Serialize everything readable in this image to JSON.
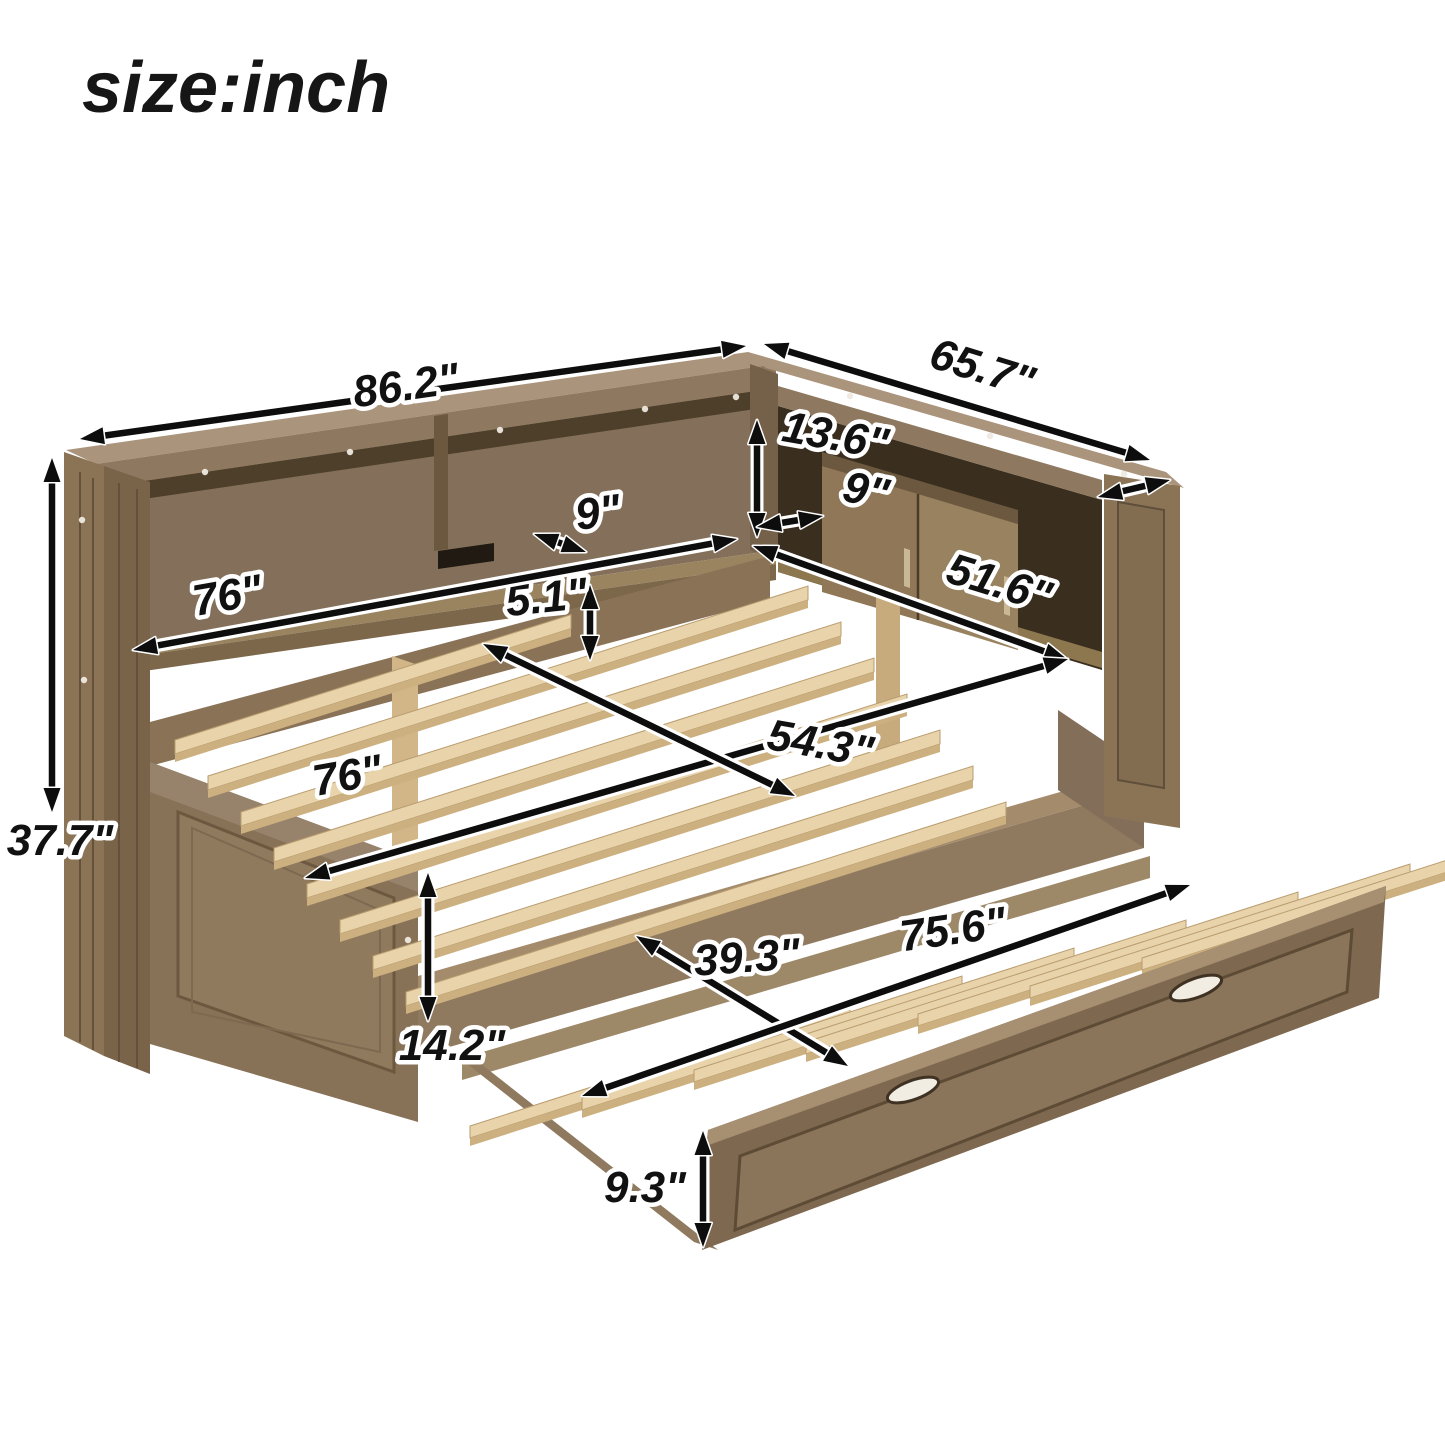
{
  "title": "size:inch",
  "dimensions": {
    "top_total_length": "86.2\"",
    "top_side_depth": "65.7\"",
    "shelf_opening_height": "13.6\"",
    "shelf_depth_left": "9\"",
    "shelf_depth_right": "9\"",
    "gap_under_shelf": "5.1\"",
    "left_shelf_length": "76\"",
    "right_shelf_length": "51.6\"",
    "bed_length": "76\"",
    "bed_width": "54.3\"",
    "total_height": "37.7\"",
    "bed_frame_height": "14.2\"",
    "trundle_width": "39.3\"",
    "trundle_length": "75.6\"",
    "trundle_panel_height": "9.3\""
  },
  "colors": {
    "background": "#ffffff",
    "arrow": "#0d0d0d",
    "label_halo": "#ffffff",
    "label_text": "#111111",
    "wood_cap": "#ab947c",
    "wood_frame": "#8b7456",
    "wood_interior_shadow": "#4e3f2a",
    "slat_wood": "#e8d3aa"
  },
  "annotations": [
    {
      "name": "top-total-length",
      "label": "86.2\"",
      "x": 408,
      "y": 400,
      "rot": -8,
      "arrow": [
        80,
        439,
        746,
        346
      ]
    },
    {
      "name": "top-side-depth",
      "label": "65.7\"",
      "x": 978,
      "y": 382,
      "rot": 17,
      "arrow": [
        764,
        344,
        1150,
        460
      ]
    },
    {
      "name": "top-cap-depth",
      "label": "",
      "x": 0,
      "y": 0,
      "rot": 0,
      "arrow": [
        1098,
        497,
        1170,
        480
      ]
    },
    {
      "name": "shelf-opening-height",
      "label": "13.6\"",
      "x": 833,
      "y": 450,
      "rot": 10,
      "arrow": [
        757,
        420,
        757,
        537
      ]
    },
    {
      "name": "shelf-depth-left",
      "label": "9\"",
      "x": 600,
      "y": 527,
      "rot": -8,
      "arrow": [
        534,
        534,
        586,
        552
      ]
    },
    {
      "name": "shelf-depth-right",
      "label": "9\"",
      "x": 863,
      "y": 505,
      "rot": 12,
      "arrow": [
        757,
        527,
        823,
        516
      ]
    },
    {
      "name": "gap-under-shelf",
      "label": "5.1\"",
      "x": 548,
      "y": 612,
      "rot": -6,
      "arrow": [
        590,
        585,
        590,
        660
      ]
    },
    {
      "name": "left-shelf-length",
      "label": "76\"",
      "x": 230,
      "y": 610,
      "rot": -10,
      "arrow": [
        133,
        650,
        737,
        539
      ]
    },
    {
      "name": "right-shelf-length",
      "label": "51.6\"",
      "x": 995,
      "y": 597,
      "rot": 17,
      "arrow": [
        753,
        546,
        1068,
        660
      ]
    },
    {
      "name": "bed-length",
      "label": "76\"",
      "x": 350,
      "y": 790,
      "rot": -10,
      "arrow": [
        305,
        878,
        1068,
        659
      ]
    },
    {
      "name": "bed-width",
      "label": "54.3\"",
      "x": 818,
      "y": 758,
      "rot": 10,
      "arrow": [
        483,
        644,
        795,
        796
      ]
    },
    {
      "name": "total-height",
      "label": "37.7\"",
      "x": 60,
      "y": 855,
      "rot": 0,
      "arrow": [
        52,
        458,
        52,
        812
      ]
    },
    {
      "name": "bed-frame-height",
      "label": "14.2\"",
      "x": 452,
      "y": 1060,
      "rot": 0,
      "arrow": [
        428,
        873,
        428,
        1021
      ]
    },
    {
      "name": "trundle-width",
      "label": "39.3\"",
      "x": 748,
      "y": 972,
      "rot": -4,
      "arrow": [
        636,
        936,
        848,
        1066
      ]
    },
    {
      "name": "trundle-length",
      "label": "75.6\"",
      "x": 955,
      "y": 944,
      "rot": -8,
      "arrow": [
        582,
        1096,
        1190,
        885
      ]
    },
    {
      "name": "trundle-panel-height",
      "label": "9.3\"",
      "x": 645,
      "y": 1202,
      "rot": 0,
      "arrow": [
        703,
        1131,
        703,
        1247
      ]
    }
  ]
}
